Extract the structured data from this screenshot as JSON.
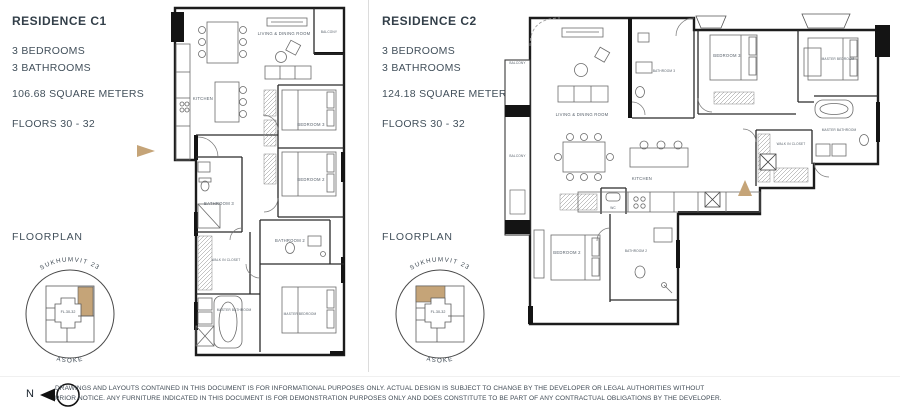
{
  "page": {
    "background": "#ffffff",
    "text_color": "#3f4a54",
    "accent_tan": "#c5a478",
    "wall_color": "#1c1c1c"
  },
  "residences": [
    {
      "title": "RESIDENCE C1",
      "bedrooms": "3 BEDROOMS",
      "bathrooms": "3 BATHROOMS",
      "area": "106.68 SQUARE METERS",
      "floors": "FLOORS 30 - 32",
      "floorplan_heading": "FLOORPLAN",
      "keyplan": {
        "street_top": "SUKHUMVIT 23",
        "street_bottom": "ASOKE",
        "unit_floors": "FL.30-32"
      },
      "rooms": {
        "living": "LIVING & DINING ROOM",
        "balcony": "BALCONY",
        "kitchen": "KITCHEN",
        "bedroom3": "BEDROOM 3",
        "bedroom2": "BEDROOM 2",
        "bathroom3": "BATHROOM 3",
        "bathroom2": "BATHROOM 2",
        "walk_in_closet": "WALK IN CLOSET",
        "master_bathroom": "MASTER BATHROOM",
        "master_bedroom": "MASTER BEDROOM"
      }
    },
    {
      "title": "RESIDENCE C2",
      "bedrooms": "3 BEDROOMS",
      "bathrooms": "3 BATHROOMS",
      "area": "124.18 SQUARE METERS",
      "floors": "FLOORS 30 - 32",
      "floorplan_heading": "FLOORPLAN",
      "keyplan": {
        "street_top": "SUKHUMVIT 23",
        "street_bottom": "ASOKE",
        "unit_floors": "FL.30-32"
      },
      "rooms": {
        "balcony_upper": "BALCONY",
        "balcony_lower": "BALCONY",
        "living": "LIVING & DINING ROOM",
        "bathroom3": "BATHROOM 3",
        "bedroom3": "BEDROOM 3",
        "master_bedroom": "MASTER BEDROOM",
        "master_bathroom": "MASTER BATHROOM",
        "walk_in_closet": "WALK IN CLOSET",
        "kitchen": "KITCHEN",
        "wc": "WC",
        "bedroom2": "BEDROOM 2",
        "bathroom2": "BATHROOM 2"
      }
    }
  ],
  "footer": {
    "north_label": "N",
    "disclaimer_line1": "DRAWINGS AND LAYOUTS CONTAINED IN THIS DOCUMENT IS FOR INFORMATIONAL PURPOSES ONLY. ACTUAL DESIGN IS SUBJECT TO CHANGE BY THE DEVELOPER OR LEGAL AUTHORITIES WITHOUT",
    "disclaimer_line2": "PRIOR NOTICE. ANY FURNITURE INDICATED IN THIS DOCUMENT IS FOR DEMONSTRATION PURPOSES ONLY AND DOES CONSTITUTE TO BE PART OF ANY CONTRACTUAL OBLIGATIONS BY THE DEVELOPER."
  }
}
